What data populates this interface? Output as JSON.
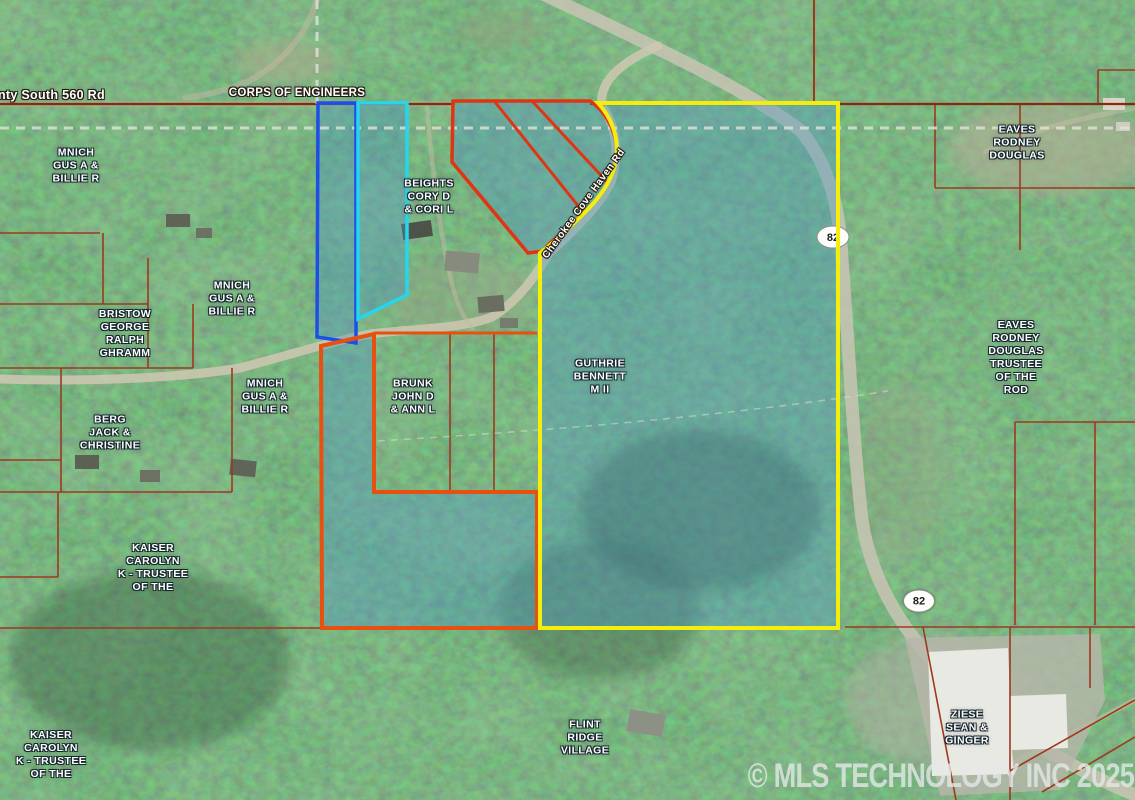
{
  "map": {
    "road_labels": {
      "county_road": "nty South 560 Rd",
      "corps": "CORPS OF ENGINEERS",
      "cherokee": "Cherokee Cove Haven Rd"
    },
    "owner_labels": [
      {
        "id": "mnich-1",
        "lines": [
          "MNICH",
          "GUS A &",
          "BILLIE R"
        ]
      },
      {
        "id": "beights",
        "lines": [
          "BEIGHTS",
          "CORY D",
          "& CORI L"
        ]
      },
      {
        "id": "mnich-2",
        "lines": [
          "MNICH",
          "GUS A &",
          "BILLIE R"
        ]
      },
      {
        "id": "bristow",
        "lines": [
          "BRISTOW",
          "GEORGE",
          "RALPH",
          "GHRAMM"
        ]
      },
      {
        "id": "mnich-3",
        "lines": [
          "MNICH",
          "GUS A &",
          "BILLIE R"
        ]
      },
      {
        "id": "brunk",
        "lines": [
          "BRUNK",
          "JOHN D",
          "& ANN L"
        ]
      },
      {
        "id": "guthrie",
        "lines": [
          "GUTHRIE",
          "BENNETT",
          "M II"
        ]
      },
      {
        "id": "berg",
        "lines": [
          "BERG",
          "JACK &",
          "CHRISTINE"
        ]
      },
      {
        "id": "eaves-1",
        "lines": [
          "EAVES",
          "RODNEY",
          "DOUGLAS"
        ]
      },
      {
        "id": "eaves-2",
        "lines": [
          "EAVES",
          "RODNEY",
          "DOUGLAS",
          "TRUSTEE",
          "OF THE",
          "ROD"
        ]
      },
      {
        "id": "kaiser-1",
        "lines": [
          "KAISER",
          "CAROLYN",
          "K - TRUSTEE",
          "OF THE"
        ]
      },
      {
        "id": "kaiser-2",
        "lines": [
          "KAISER",
          "CAROLYN",
          "K - TRUSTEE",
          "OF THE"
        ]
      },
      {
        "id": "flint-ridge",
        "lines": [
          "FLINT",
          "RIDGE",
          "VILLAGE"
        ]
      },
      {
        "id": "ziese",
        "lines": [
          "ZIESE",
          "SEAN &",
          "GINGER"
        ]
      }
    ],
    "highway_shields": [
      {
        "label": "82"
      },
      {
        "label": "82"
      }
    ],
    "watermark": "© MLS TECHNOLOGY INC 2025",
    "colors": {
      "highlight_fill": "rgba(80,150,195,0.40)",
      "boundary_red": "#e03412",
      "boundary_red_orange": "#e8500f",
      "boundary_yellow": "#f4ee0e",
      "boundary_blue": "#1d4ee8",
      "boundary_cyan": "#25d6ec",
      "parcel_line": "#9c3a1d",
      "road_line": "#86290e",
      "dashed_line": "#e2e2da"
    }
  }
}
